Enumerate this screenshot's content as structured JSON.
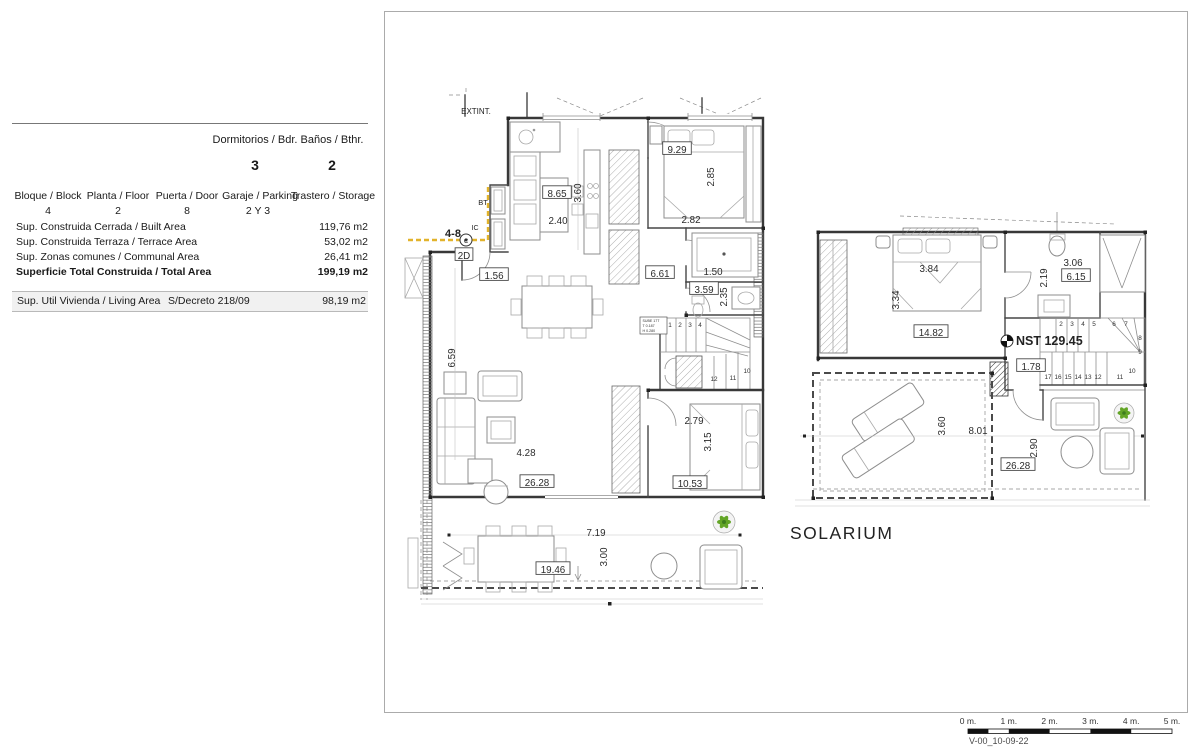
{
  "info_panel": {
    "top_cols": [
      {
        "label": "Dormitorios / Bdr.",
        "value": "3"
      },
      {
        "label": "Baños / Bthr.",
        "value": "2"
      }
    ],
    "unit_cols": [
      {
        "label": "Bloque / Block",
        "value": "4"
      },
      {
        "label": "Planta / Floor",
        "value": "2"
      },
      {
        "label": "Puerta / Door",
        "value": "8"
      },
      {
        "label": "Garaje / Parking",
        "value": "2 Y 3"
      },
      {
        "label": "Trastero / Storage",
        "value": ""
      }
    ],
    "area_rows": [
      {
        "label": "Sup. Construida Cerrada / Built Area",
        "value": "119,76 m2"
      },
      {
        "label": "Sup. Construida Terraza / Terrace Area",
        "value": "53,02 m2"
      },
      {
        "label": "Sup. Zonas comunes / Communal Area",
        "value": "26,41 m2"
      },
      {
        "label": "Superficie Total Construida / Total Area",
        "value": "199,19 m2"
      }
    ],
    "living_row": {
      "label": "Sup. Util Vivienda / Living Area",
      "decree": "S/Decreto 218/09",
      "value": "98,19 m2"
    }
  },
  "drawing": {
    "solarium_label": "SOLARIUM",
    "boxed_labels": [
      {
        "t": "9.29",
        "x": 677,
        "y": 151
      },
      {
        "t": "8.65",
        "x": 557,
        "y": 195
      },
      {
        "t": "1.56",
        "x": 494,
        "y": 277
      },
      {
        "t": "2D",
        "x": 464,
        "y": 257
      },
      {
        "t": "6.61",
        "x": 660,
        "y": 275
      },
      {
        "t": "3.59",
        "x": 704,
        "y": 291
      },
      {
        "t": "26.28",
        "x": 537,
        "y": 484
      },
      {
        "t": "10.53",
        "x": 690,
        "y": 485
      },
      {
        "t": "19.46",
        "x": 553,
        "y": 571
      },
      {
        "t": "14.82",
        "x": 931,
        "y": 334
      },
      {
        "t": "6.15",
        "x": 1076,
        "y": 278
      },
      {
        "t": "1.78",
        "x": 1031,
        "y": 368
      },
      {
        "t": "26.28",
        "x": 1018,
        "y": 467
      }
    ],
    "plain_labels": [
      {
        "t": "3.60",
        "x": 578,
        "y": 193,
        "r": 1
      },
      {
        "t": "2.40",
        "x": 558,
        "y": 221
      },
      {
        "t": "2.85",
        "x": 711,
        "y": 177,
        "r": 1
      },
      {
        "t": "2.82",
        "x": 691,
        "y": 220
      },
      {
        "t": "1.50",
        "x": 713,
        "y": 272
      },
      {
        "t": "2.35",
        "x": 724,
        "y": 297,
        "r": 1
      },
      {
        "t": "6.59",
        "x": 452,
        "y": 358,
        "r": 1
      },
      {
        "t": "4.28",
        "x": 526,
        "y": 453
      },
      {
        "t": "2.79",
        "x": 694,
        "y": 421
      },
      {
        "t": "3.15",
        "x": 708,
        "y": 442,
        "r": 1
      },
      {
        "t": "7.19",
        "x": 596,
        "y": 533
      },
      {
        "t": "3.00",
        "x": 604,
        "y": 557,
        "r": 1
      },
      {
        "t": "3.84",
        "x": 929,
        "y": 269
      },
      {
        "t": "3.34",
        "x": 896,
        "y": 300,
        "r": 1
      },
      {
        "t": "3.06",
        "x": 1073,
        "y": 263
      },
      {
        "t": "2.19",
        "x": 1044,
        "y": 278,
        "r": 1
      },
      {
        "t": "3.60",
        "x": 942,
        "y": 426,
        "r": 1
      },
      {
        "t": "8.01",
        "x": 978,
        "y": 431
      },
      {
        "t": "2.90",
        "x": 1034,
        "y": 448,
        "r": 1
      }
    ],
    "notes": [
      {
        "t": "EXTINT.",
        "x": 476,
        "y": 114,
        "s": 8
      },
      {
        "t": "BT",
        "x": 483,
        "y": 205,
        "s": 7.5
      },
      {
        "t": "4-8",
        "x": 453,
        "y": 237,
        "s": 11,
        "b": 1
      },
      {
        "t": "IC",
        "x": 475,
        "y": 230,
        "s": 7
      },
      {
        "t": "C",
        "x": 466,
        "y": 243,
        "s": 6
      },
      {
        "t": "SOLARIUM",
        "x": 790,
        "y": 539,
        "s": 17.5,
        "a": "start",
        "ls": 1.5,
        "c": "#3f3f3f"
      },
      {
        "t": "NST 129.45",
        "x": 1016,
        "y": 345,
        "s": 12.5,
        "b": 1,
        "a": "start"
      }
    ],
    "stair_steps_main": [
      {
        "t": "1",
        "x": 670,
        "y": 327
      },
      {
        "t": "2",
        "x": 680,
        "y": 327
      },
      {
        "t": "3",
        "x": 690,
        "y": 327
      },
      {
        "t": "4",
        "x": 700,
        "y": 327
      },
      {
        "t": "12",
        "x": 714,
        "y": 381
      },
      {
        "t": "11",
        "x": 733,
        "y": 380
      },
      {
        "t": "10",
        "x": 747,
        "y": 373
      }
    ],
    "stair_steps_upper": [
      {
        "t": "2",
        "x": 1061,
        "y": 326
      },
      {
        "t": "3",
        "x": 1072,
        "y": 326
      },
      {
        "t": "4",
        "x": 1083,
        "y": 326
      },
      {
        "t": "5",
        "x": 1094,
        "y": 326
      },
      {
        "t": "6",
        "x": 1114,
        "y": 326
      },
      {
        "t": "7",
        "x": 1126,
        "y": 326
      },
      {
        "t": "8",
        "x": 1140,
        "y": 340
      },
      {
        "t": "9",
        "x": 1140,
        "y": 354
      },
      {
        "t": "10",
        "x": 1132,
        "y": 373
      },
      {
        "t": "11",
        "x": 1120,
        "y": 379
      },
      {
        "t": "17",
        "x": 1048,
        "y": 379
      },
      {
        "t": "16",
        "x": 1058,
        "y": 379
      },
      {
        "t": "15",
        "x": 1068,
        "y": 379
      },
      {
        "t": "14",
        "x": 1078,
        "y": 379
      },
      {
        "t": "13",
        "x": 1088,
        "y": 379
      },
      {
        "t": "12",
        "x": 1098,
        "y": 379
      }
    ],
    "stair_note_lines": [
      "SUBE 17T",
      "T 0.187",
      "H 0.280"
    ],
    "colors": {
      "highlight_yellow": "#e2b32b",
      "plant_green": "#63a527"
    }
  },
  "scale_bar": {
    "ticks": [
      "0 m.",
      "1 m.",
      "2 m.",
      "3 m.",
      "4 m.",
      "5 m."
    ],
    "version": "V-00_10-09-22"
  }
}
